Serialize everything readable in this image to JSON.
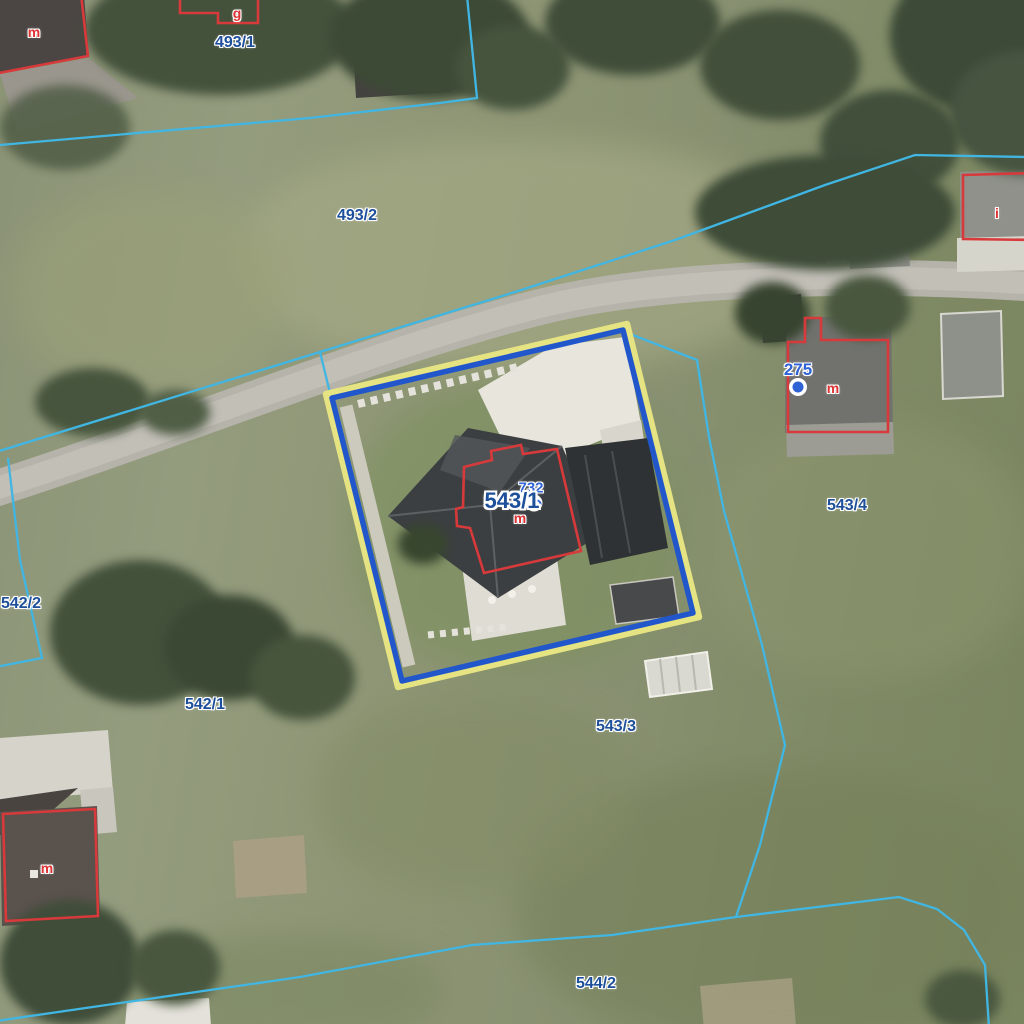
{
  "map": {
    "title": "Cadastral aerial map",
    "selected_parcel": "543/1",
    "colors": {
      "parcel_boundary_cyan": "#41b6e3",
      "selection_outline_blue": "#2257cb",
      "selection_halo_yellow": "#e6e383",
      "building_outline_red": "#d8393b",
      "parcel_label_blue": "#1e4f9a",
      "building_number_blue": "#2f62d4",
      "building_letter_red": "#e03232"
    },
    "parcel_labels": {
      "p493_1": "493/1",
      "p493_2": "493/2",
      "p542_2": "542/2",
      "p542_1": "542/1",
      "p543_1": "543/1",
      "p543_3": "543/3",
      "p543_4": "543/4",
      "p544_2": "544/2"
    },
    "building_numbers": {
      "b732": "732",
      "b275": "275"
    },
    "building_letters": {
      "m_topleft": "m",
      "g_top": "g",
      "i_right": "i",
      "m_center": "m",
      "m_275": "m",
      "m_bottomleft": "m"
    },
    "symbols": {
      "building_point_275": "filled-blue-dot",
      "building_point_543_1": "open-blue-circle"
    }
  }
}
